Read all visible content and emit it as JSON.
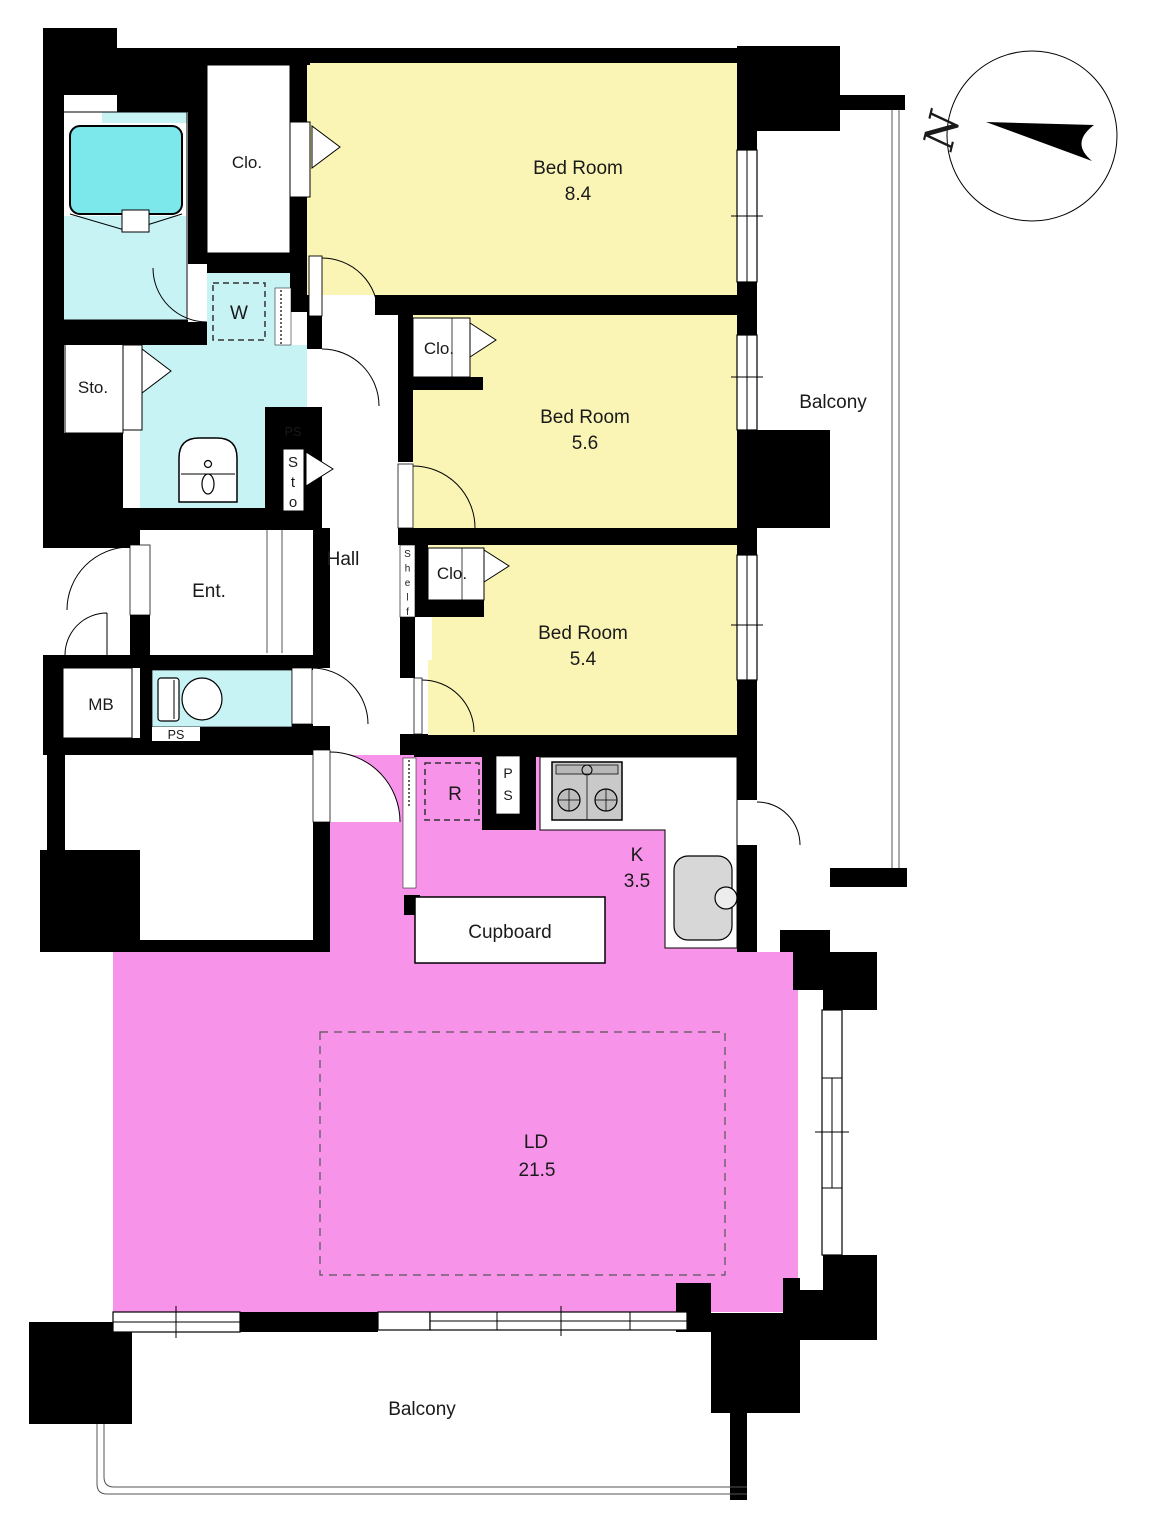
{
  "title": "Apartment floor plan 3LDK",
  "colors": {
    "wall": "#000000",
    "bedroom": "#FAF5B5",
    "living": "#F893EA",
    "wet_floor": "#C7F3F5",
    "bathtub": "#7CE8EC",
    "counter_gray": "#C9C9C9",
    "sink_gray": "#D7D7D7",
    "outline_thin": "#555555"
  },
  "compass": {
    "north": "N"
  },
  "rooms": {
    "bedroom_main": {
      "label": "Bed Room",
      "area": "8.4"
    },
    "bedroom_mid": {
      "label": "Bed Room",
      "area": "5.6"
    },
    "bedroom_small": {
      "label": "Bed Room",
      "area": "5.4"
    },
    "living_dining": {
      "label": "LD",
      "area": "21.5"
    },
    "kitchen": {
      "label": "K",
      "area": "3.5"
    },
    "hall": {
      "label": "Hall"
    },
    "entrance": {
      "label": "Ent."
    },
    "balcony_east": {
      "label": "Balcony"
    },
    "balcony_south": {
      "label": "Balcony"
    },
    "closet_main": {
      "label": "Clo."
    },
    "closet_mid": {
      "label": "Clo."
    },
    "closet_small": {
      "label": "Clo."
    },
    "storage_hall": {
      "label": "Sto."
    },
    "storage_closet": {
      "label": "Sto"
    },
    "washer": {
      "label": "W"
    },
    "meter_box": {
      "label": "MB"
    },
    "pipe_space_hall": {
      "label": "PS"
    },
    "pipe_space_toilet": {
      "label": "PS"
    },
    "pipe_space_kitchen": {
      "label": "PS"
    },
    "refrigerator": {
      "label": "R"
    },
    "shelf": {
      "label": "Shelf"
    },
    "cupboard": {
      "label": "Cupboard"
    }
  }
}
